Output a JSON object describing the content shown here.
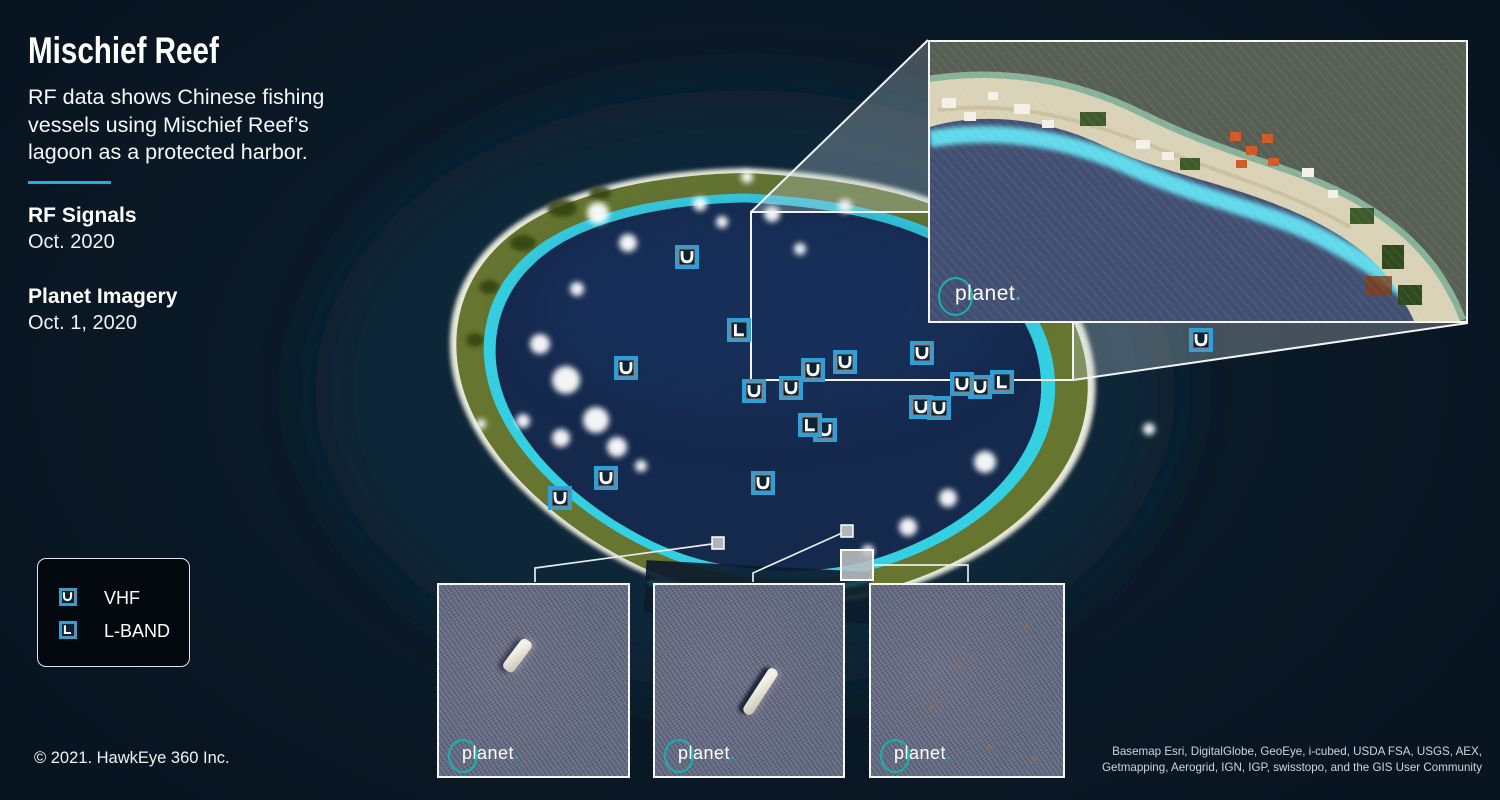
{
  "panel": {
    "title": "Mischief Reef",
    "description": "RF data shows Chinese fishing vessels using Mischief Reef’s lagoon as a protected harbor.",
    "rf_heading": "RF Signals",
    "rf_date": "Oct. 2020",
    "imagery_heading": "Planet Imagery",
    "imagery_date": "Oct. 1, 2020",
    "copyright": "© 2021. HawkEye 360 Inc."
  },
  "legend": {
    "items": [
      {
        "icon": "vhf-marker-icon",
        "band": "VHF",
        "label": "VHF"
      },
      {
        "icon": "lband-marker-icon",
        "band": "L-BAND",
        "label": "L-BAND"
      }
    ]
  },
  "brand": {
    "name": "planet",
    "dot": "."
  },
  "attribution": {
    "line1": "Basemap Esri, DigitalGlobe, GeoEye, i-cubed, USDA FSA, USGS, AEX,",
    "line2": "Getmapping, Aerogrid, IGN, IGP, swisstopo, and the GIS User Community"
  },
  "map": {
    "markers": [
      {
        "band": "VHF",
        "x": 687,
        "y": 257
      },
      {
        "band": "L-BAND",
        "x": 739,
        "y": 330
      },
      {
        "band": "VHF",
        "x": 626,
        "y": 368
      },
      {
        "band": "VHF",
        "x": 813,
        "y": 370
      },
      {
        "band": "VHF",
        "x": 845,
        "y": 362
      },
      {
        "band": "VHF",
        "x": 922,
        "y": 353
      },
      {
        "band": "VHF",
        "x": 754,
        "y": 391
      },
      {
        "band": "VHF",
        "x": 791,
        "y": 388
      },
      {
        "band": "VHF",
        "x": 980,
        "y": 387
      },
      {
        "band": "VHF",
        "x": 962,
        "y": 384
      },
      {
        "band": "L-BAND",
        "x": 1002,
        "y": 382
      },
      {
        "band": "VHF",
        "x": 921,
        "y": 407
      },
      {
        "band": "VHF",
        "x": 939,
        "y": 408
      },
      {
        "band": "VHF",
        "x": 825,
        "y": 430
      },
      {
        "band": "L-BAND",
        "x": 810,
        "y": 425
      },
      {
        "band": "VHF",
        "x": 1201,
        "y": 340
      },
      {
        "band": "VHF",
        "x": 606,
        "y": 478
      },
      {
        "band": "VHF",
        "x": 560,
        "y": 498
      },
      {
        "band": "VHF",
        "x": 763,
        "y": 483
      }
    ]
  },
  "colors": {
    "background": "#0b1a27",
    "accent_cyan": "#2aa9e2",
    "marker_blue": "#2d9fd9",
    "planet_teal": "#16b3ad",
    "lagoon_blue": "#15294d",
    "reef_green": "#66752f"
  }
}
